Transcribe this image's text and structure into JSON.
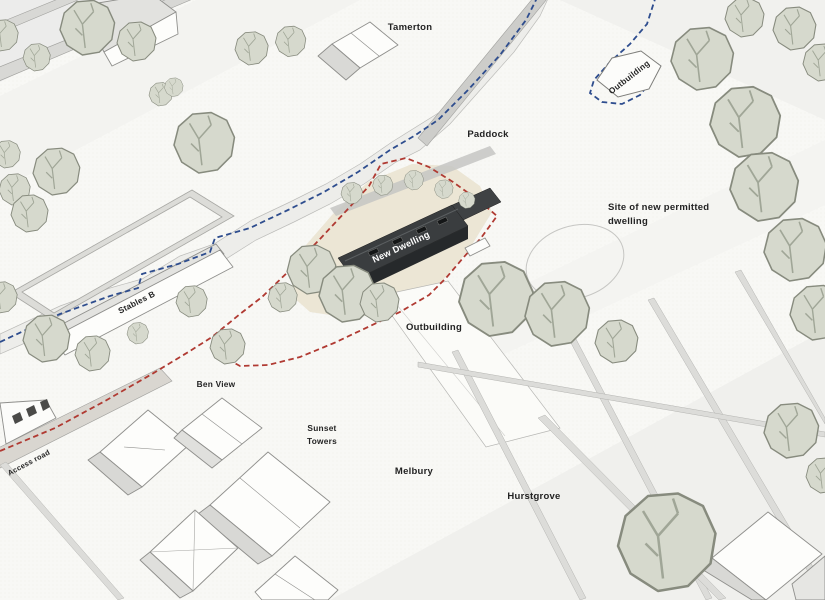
{
  "colors": {
    "boundary_red": "#b03a32",
    "route_blue": "#2e4d8e",
    "tree_fill": "#d6d9cd",
    "tree_stroke": "#878b7e",
    "new_dwelling_roof": "#3a3d3f",
    "site_ground": "#eae3d1"
  },
  "labels": {
    "tamerton": "Tamerton",
    "outbuilding_top": "Outbuilding",
    "paddock": "Paddock",
    "site_note_line1": "Site of new permitted",
    "site_note_line2": "dwelling",
    "new_dwelling": "New Dwelling",
    "outbuilding_mid": "Outbuilding",
    "stables_b": "Stables B",
    "ben_view": "Ben View",
    "sunset_towers_line1": "Sunset",
    "sunset_towers_line2": "Towers",
    "melbury": "Melbury",
    "hurstgrove": "Hurstgrove",
    "access_road": "Access road"
  }
}
